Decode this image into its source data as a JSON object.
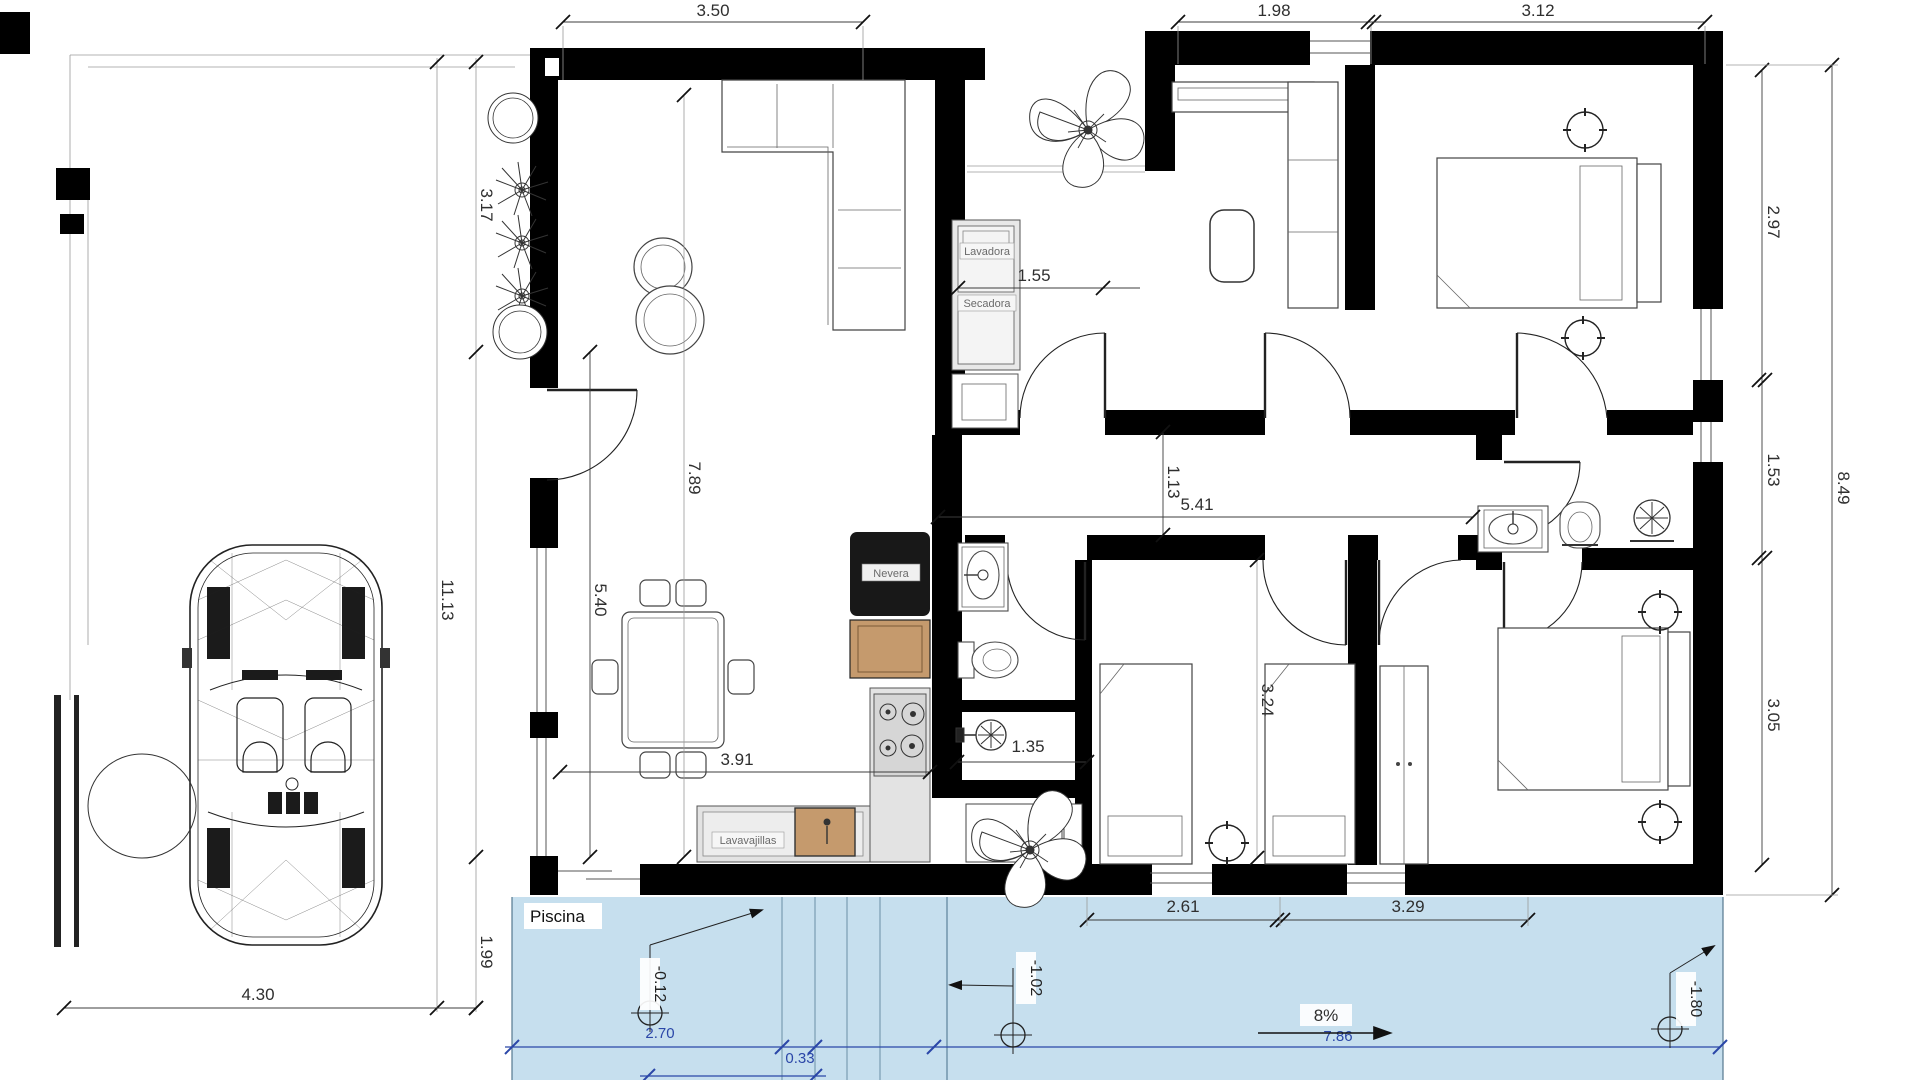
{
  "plan": {
    "pool_label": "Piscina",
    "appliances": {
      "washer": "Lavadora",
      "dryer": "Secadora",
      "fridge": "Nevera",
      "dishwasher": "Lavavajillas"
    },
    "dims": {
      "top_living": "3.50",
      "top_dressing": "1.98",
      "top_bedroom": "3.12",
      "left_upper": "3.17",
      "left_total": "11.13",
      "left_lower": "5.40",
      "left_pool_gap": "1.99",
      "bottom_left": "4.30",
      "right_bedroom_top": "2.97",
      "right_total": "8.49",
      "right_bath": "1.53",
      "right_bedroom_bottom": "3.05",
      "living_depth": "7.89",
      "laundry_width": "1.55",
      "hall_width": "1.13",
      "hall_length": "5.41",
      "kitchen_width": "3.91",
      "bath_small_width": "1.35",
      "bedrooms_depth": "3.24",
      "bedroom_a_width": "2.61",
      "bedroom_b_width": "3.29"
    },
    "pool_dims": {
      "steps_offset": "2.70",
      "step_width": "0.33",
      "length": "7.86",
      "slope": "8%"
    },
    "levels": {
      "terrace": "-0.12",
      "pool_mid": "-1.02",
      "pool_deep": "-1.80"
    },
    "colors": {
      "pool_fill": "#c6dfee",
      "dim_blue": "#2b47a8",
      "cabinet_wood": "#c59a6d",
      "wall": "#000000",
      "counter": "#e3e3e3"
    }
  }
}
